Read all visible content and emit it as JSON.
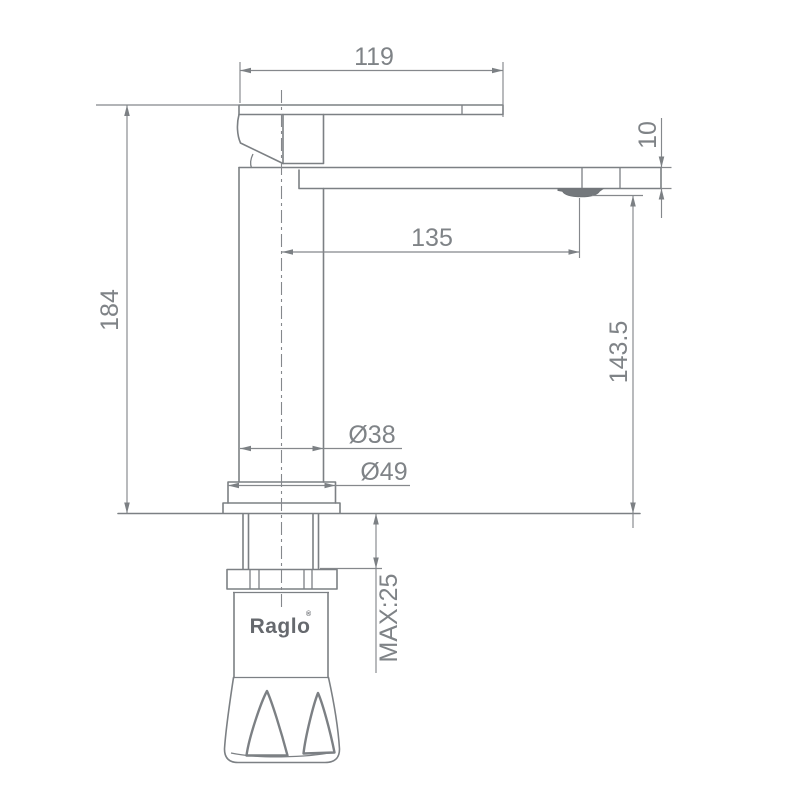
{
  "drawing": {
    "title": "faucet-dimension-drawing",
    "brand": {
      "name": "Raglo",
      "mark": "®"
    },
    "dimensions": {
      "spout_top_width": {
        "label": "119"
      },
      "spout_thickness": {
        "label": "10"
      },
      "spout_reach": {
        "label": "135"
      },
      "total_height": {
        "label": "184"
      },
      "spout_outlet_height": {
        "label": "143.5"
      },
      "body_diameter": {
        "label": "Ø38"
      },
      "base_diameter": {
        "label": "Ø49"
      },
      "max_mounting_thickness": {
        "label": "MAX:25"
      }
    },
    "colors": {
      "background": "#ffffff",
      "line": "#7c8084",
      "dimension_line": "#85888c",
      "text": "#7f8387",
      "logo": "#66696e",
      "aerator_fill": "#74787c"
    }
  }
}
